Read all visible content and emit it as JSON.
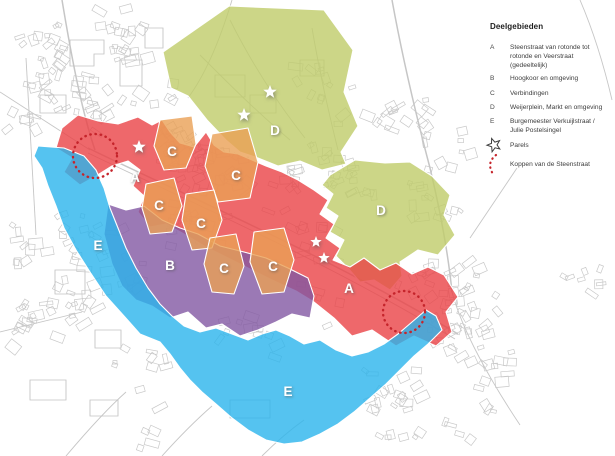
{
  "legend": {
    "title": "Deelgebieden",
    "items": [
      {
        "key": "A",
        "label": "Steenstraat van rotonde tot rotonde en Veerstraat (gedeeltelijk)"
      },
      {
        "key": "B",
        "label": "Hoogkoor en omgeving"
      },
      {
        "key": "C",
        "label": "Verbindingen"
      },
      {
        "key": "D",
        "label": "Weijerplein, Markt en omgeving"
      },
      {
        "key": "E",
        "label": "Burgemeester Verkuijlstraat / Julie Postelsingel"
      }
    ],
    "symbols": [
      {
        "icon": "star-icon",
        "label": "Parels"
      },
      {
        "icon": "dashed-arc-icon",
        "label": "Koppen van de Steenstraat"
      }
    ]
  },
  "colors": {
    "zone_a_red": "#ea4246",
    "zone_b_purple": "#8258a2",
    "zone_c_orange": "#eaa055",
    "zone_d_green": "#bfcc69",
    "zone_e_blue": "#2ab4ec",
    "koppen_red": "#c5242b",
    "building_outline": "#c9c9c9",
    "road_line": "#c6c6c6",
    "legend_text": "#3d3d3d"
  },
  "map": {
    "zone_labels": [
      {
        "text": "A",
        "x": 135,
        "y": 177
      },
      {
        "text": "A",
        "x": 349,
        "y": 288
      },
      {
        "text": "B",
        "x": 170,
        "y": 265
      },
      {
        "text": "C",
        "x": 172,
        "y": 151
      },
      {
        "text": "C",
        "x": 236,
        "y": 175
      },
      {
        "text": "C",
        "x": 159,
        "y": 205
      },
      {
        "text": "C",
        "x": 201,
        "y": 223
      },
      {
        "text": "C",
        "x": 224,
        "y": 268
      },
      {
        "text": "C",
        "x": 273,
        "y": 266
      },
      {
        "text": "D",
        "x": 275,
        "y": 130
      },
      {
        "text": "D",
        "x": 381,
        "y": 210
      },
      {
        "text": "E",
        "x": 98,
        "y": 245
      },
      {
        "text": "E",
        "x": 288,
        "y": 391
      }
    ],
    "pearls": [
      {
        "x": 139,
        "y": 147,
        "r": 7
      },
      {
        "x": 244,
        "y": 115,
        "r": 7
      },
      {
        "x": 270,
        "y": 92,
        "r": 7
      },
      {
        "x": 316,
        "y": 242,
        "r": 6
      },
      {
        "x": 324,
        "y": 258,
        "r": 6
      }
    ],
    "koppen_circles": [
      {
        "x": 95,
        "y": 156,
        "r": 22
      },
      {
        "x": 404,
        "y": 312,
        "r": 21
      }
    ]
  }
}
